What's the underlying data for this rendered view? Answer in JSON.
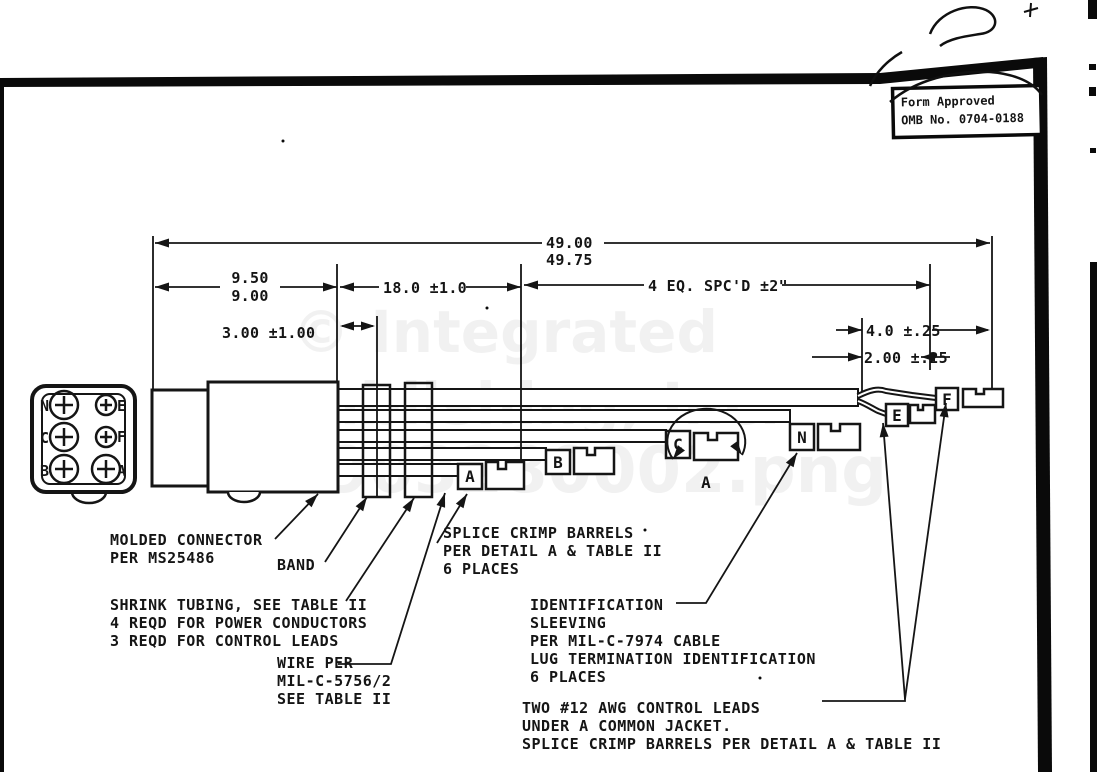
{
  "stamp": {
    "line1": "Form Approved",
    "line2": "OMB No. 0704-0188"
  },
  "watermark": {
    "line1": "© Integrated",
    "line2": "Publishing, Inc.",
    "line3": "MS903280002.png"
  },
  "dims": {
    "overall_a": "49.00",
    "overall_b": "49.75",
    "seg1_a": "9.50",
    "seg1_b": "9.00",
    "seg2": "18.0 ±1.0",
    "seg3": "4 EQ. SPC'D ±2\"",
    "band": "3.00 ±1.00",
    "lead": "4.0 ±.25",
    "lug": "2.00 ±.25"
  },
  "pins": {
    "n": "N",
    "e": "E",
    "c": "C",
    "f": "F",
    "b": "B",
    "a": "A"
  },
  "markers": {
    "a": "A",
    "b": "B",
    "c": "C",
    "n": "N",
    "e": "E",
    "f": "F"
  },
  "detail_label": "A",
  "callouts": {
    "molded": [
      "MOLDED CONNECTOR",
      "PER MS25486"
    ],
    "band": [
      "BAND"
    ],
    "shrink": [
      "SHRINK TUBING, SEE TABLE II",
      "4 REQD FOR POWER CONDUCTORS",
      "3 REQD FOR CONTROL LEADS"
    ],
    "wire": [
      "WIRE PER",
      "MIL-C-5756/2",
      "SEE TABLE II"
    ],
    "splice": [
      "SPLICE CRIMP BARRELS",
      "PER DETAIL A & TABLE II",
      "6 PLACES"
    ],
    "ident": [
      "IDENTIFICATION",
      "SLEEVING",
      "PER MIL-C-7974 CABLE",
      "LUG TERMINATION IDENTIFICATION",
      "6 PLACES"
    ],
    "awg": [
      "TWO #12 AWG CONTROL LEADS",
      "UNDER A COMMON JACKET.",
      "SPLICE CRIMP BARRELS PER DETAIL A & TABLE II"
    ]
  }
}
